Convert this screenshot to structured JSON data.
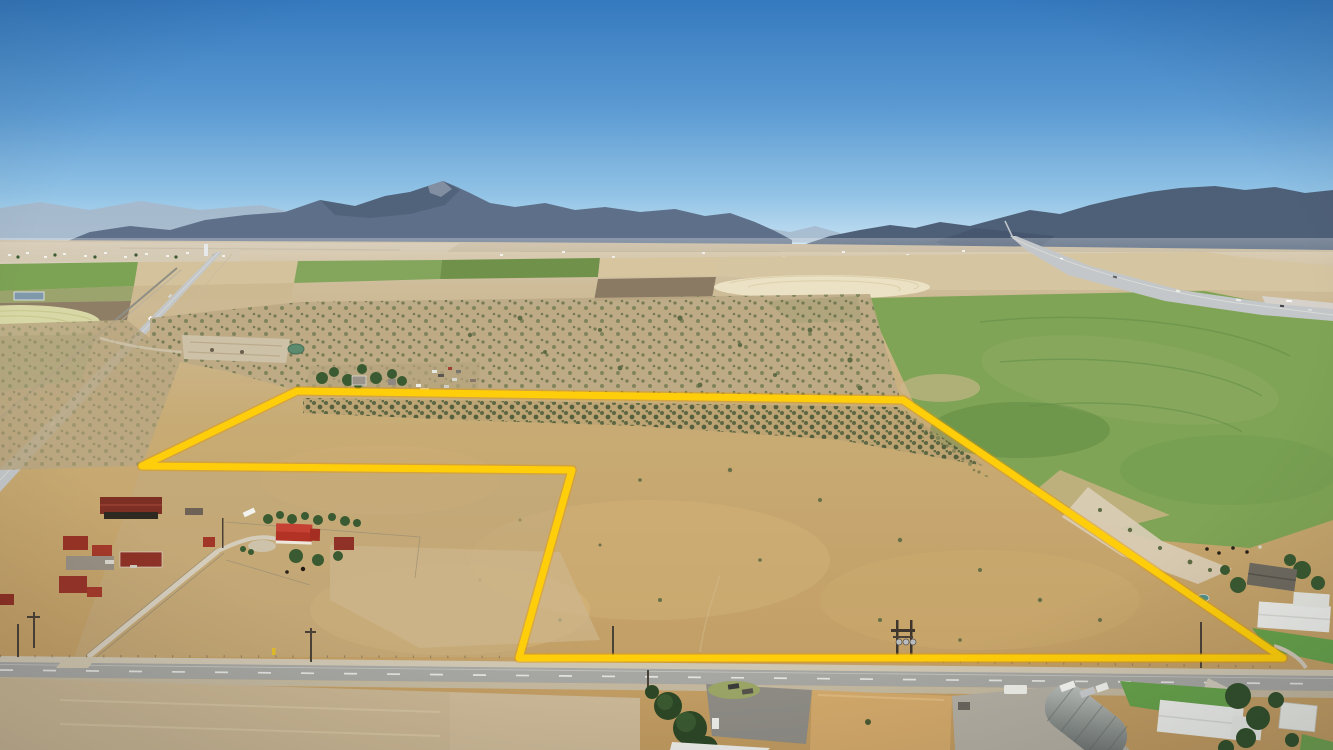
{
  "scene": {
    "type": "aerial-drone-photograph",
    "subject": "rural land parcel outlined in yellow",
    "environment": "high-desert farm valley with mountain backdrop, two highways, farmsteads and irrigated fields",
    "conditions": "clear midday sky"
  },
  "colors": {
    "sky_top": "#3579BE",
    "sky_mid": "#5C9BD3",
    "sky_low": "#93C4E6",
    "sky_horizon": "#C6E1F2",
    "mountain_far": "#A6B8CB",
    "mountain_main": "#5E7089",
    "mountain_right": "#4E6078",
    "foothill": "#C2B295",
    "valley_light": "#CFC0A2",
    "dry_grass": "#C8AB74",
    "dry_grass_deep": "#C09A60",
    "sage_dark": "#5E6B44",
    "field_green": "#7FA455",
    "field_green_dark": "#4D793B",
    "field_cream": "#EBE1C4",
    "plowed_brown": "#8A7A64",
    "road_asphalt": "#A6A6A2",
    "highway_gray": "#C4C7C9",
    "boundary_yellow": "#FFCE0A",
    "boundary_glow": "#E09A00",
    "roof_red": "#B23226",
    "roof_dark_red": "#7E2F24",
    "roof_white": "#ECEDE9",
    "tree_green": "#3A5A31",
    "lawn_green": "#67A24B",
    "gravel": "#CFC6B2",
    "dirt_pad": "#CDC1A8",
    "water_teal": "#5C8A6E"
  },
  "boundary": {
    "name": "property-boundary",
    "color": "#FFCE0A",
    "glow_color": "#E09A00",
    "stroke_width_px": 7,
    "points_px": [
      [
        297,
        391
      ],
      [
        903,
        400
      ],
      [
        1283,
        658
      ],
      [
        519,
        658
      ],
      [
        572,
        470
      ],
      [
        142,
        466
      ]
    ]
  },
  "landmarks": {
    "mountain_peak": "central-mountain-peak",
    "left_corridor": "two-lane-highway-and-railroad",
    "right_corridor": "interstate-highway",
    "front_road": "county-road",
    "notch_area": "farmstead-with-red-roofed-buildings",
    "north_neighbor": "farmyard-with-trees-and-equipment",
    "east_neighbors": "houses-with-lawns-and-trees",
    "southeast_corner": "quonset-hut-and-white-roofed-houses",
    "fields": "pivot-irrigated-green-and-fallow-fields",
    "power": "h-frame-transformer-pole",
    "town": "small-town-on-horizon"
  }
}
